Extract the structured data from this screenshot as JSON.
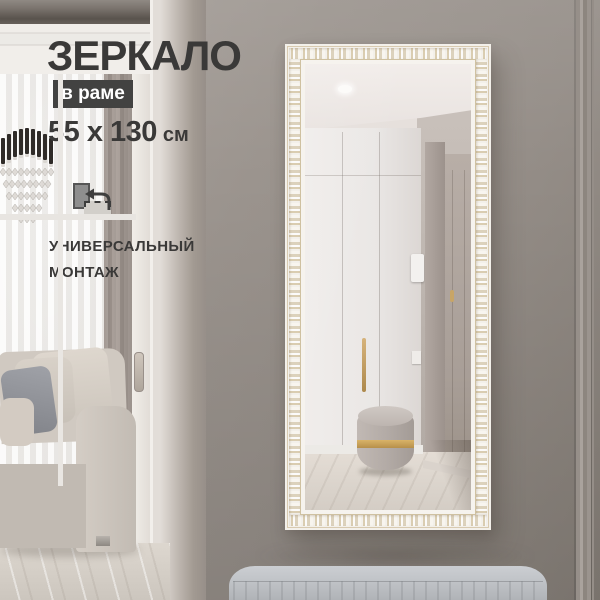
{
  "product_card": {
    "title": "ЗЕРКАЛО",
    "frame_badge": "в раме",
    "dimensions": {
      "value": "55 x 130",
      "unit": "см"
    },
    "features": {
      "line1": "УНИВЕРСАЛЬНЫЙ",
      "line2": "МОНТАЖ"
    },
    "icons": {
      "orientation": "portrait-landscape-rotate-icon"
    }
  },
  "palette": {
    "wall": "#97908a",
    "title_text": "#3a3938",
    "badge_bg": "#424241",
    "badge_text": "#ffffff",
    "frame_white": "#f3f0ea",
    "frame_gold": "#cbbd9e",
    "pouf_band_gold": "#c8a25c",
    "bench": "#c0c3c7"
  },
  "scene_objects": [
    "chandelier",
    "window-sheer-curtains",
    "curtain",
    "sofa",
    "sliding-door",
    "ornate-framed-mirror",
    "mirror-reflection-hallway",
    "wardrobe",
    "interior-door",
    "pouf",
    "marble-floor",
    "upholstered-bench"
  ]
}
